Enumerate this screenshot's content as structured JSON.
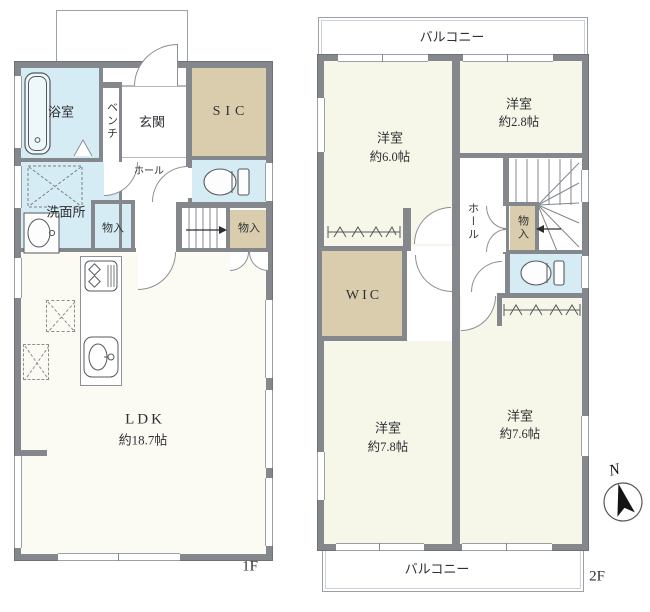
{
  "meta": {
    "type": "floor-plan"
  },
  "colors": {
    "wall": "#84878c",
    "outline": "#6d7075",
    "wet_room": "#d6ecf4",
    "closet": "#d9cdae",
    "room": "#f6f7e8",
    "ldk": "#fbfbf3"
  },
  "floor1": {
    "floor_label": "1F",
    "bath": "浴室",
    "bench": "ベンチ",
    "entrance": "玄関",
    "sic": "SIC",
    "hall": "ホール",
    "washroom": "洗面所",
    "storage_hall": "物入",
    "storage_stairs": "物入",
    "ldk_name": "LDK",
    "ldk_size": "約18.7帖"
  },
  "floor2": {
    "floor_label": "2F",
    "balcony_top": "バルコニー",
    "balcony_bottom": "バルコニー",
    "room_6_name": "洋室",
    "room_6_size": "約6.0帖",
    "room_28_name": "洋室",
    "room_28_size": "約2.8帖",
    "room_78_name": "洋室",
    "room_78_size": "約7.8帖",
    "room_76_name": "洋室",
    "room_76_size": "約7.6帖",
    "hall": "ホール",
    "wic": "WIC",
    "storage": "物入"
  },
  "compass": {
    "north": "N"
  }
}
